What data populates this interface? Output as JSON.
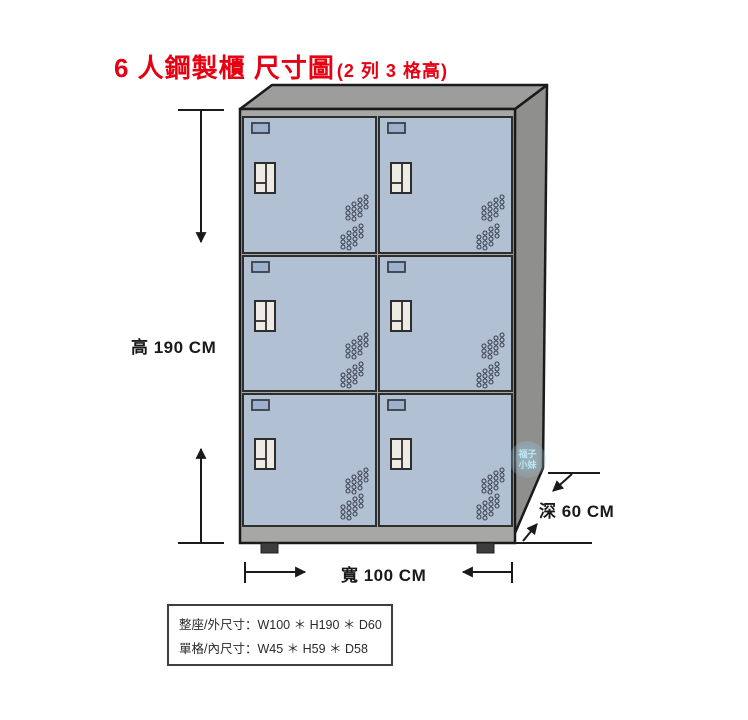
{
  "title": {
    "main": "6 人鋼製櫃 尺寸圖",
    "suffix": "(2 列 3 格高)"
  },
  "dimensions": {
    "height_label": "高 190 CM",
    "width_label": "寬 100 CM",
    "depth_label": "深 60 CM"
  },
  "spec_box": {
    "line1": "整座/外尺寸：W100 ＊ H190 ＊ D60",
    "line2": "單格/內尺寸：W45 ＊ H59 ＊ D58"
  },
  "watermark": {
    "line1": "福子",
    "line2": "小妹"
  },
  "cabinet": {
    "rows": 3,
    "columns": 2,
    "door_count": 6
  },
  "colors": {
    "title_red": "#e60012",
    "door_blue": "#b2c0d4",
    "card_slot_blue": "#9db1cf",
    "frame_gray": "#a7a7a5",
    "top_face_gray": "#9d9d9b",
    "side_face_gray": "#8f8f8d",
    "foot_dark": "#3c3c3c",
    "line_dark": "#1a1a1a"
  }
}
